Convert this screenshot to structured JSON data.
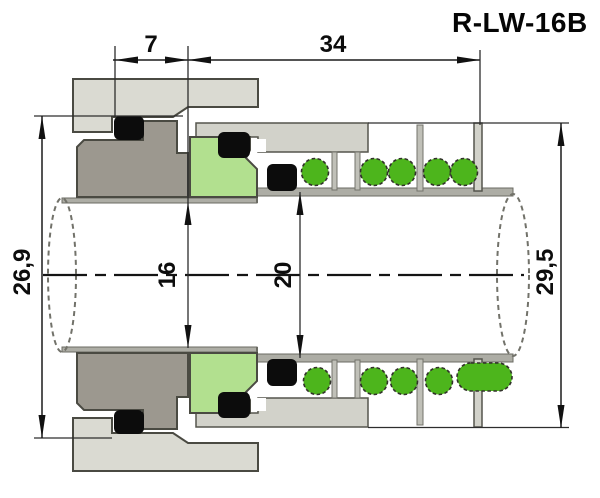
{
  "title": "R-LW-16B",
  "dimensions": {
    "top_left": "7",
    "top_right": "34",
    "left_od": "26,9",
    "shaft_small": "16",
    "shaft_large": "20",
    "right_od": "29,5"
  },
  "colors": {
    "background": "#ffffff",
    "housing_gray": "#dadad2",
    "retainer_gray": "#d2d2ca",
    "seat_gray": "#9c988f",
    "bellows_green": "#b2e08f",
    "spring_green": "#4db51c",
    "oring_black": "#0c0c0c",
    "shaft_gray": "#adada5"
  }
}
